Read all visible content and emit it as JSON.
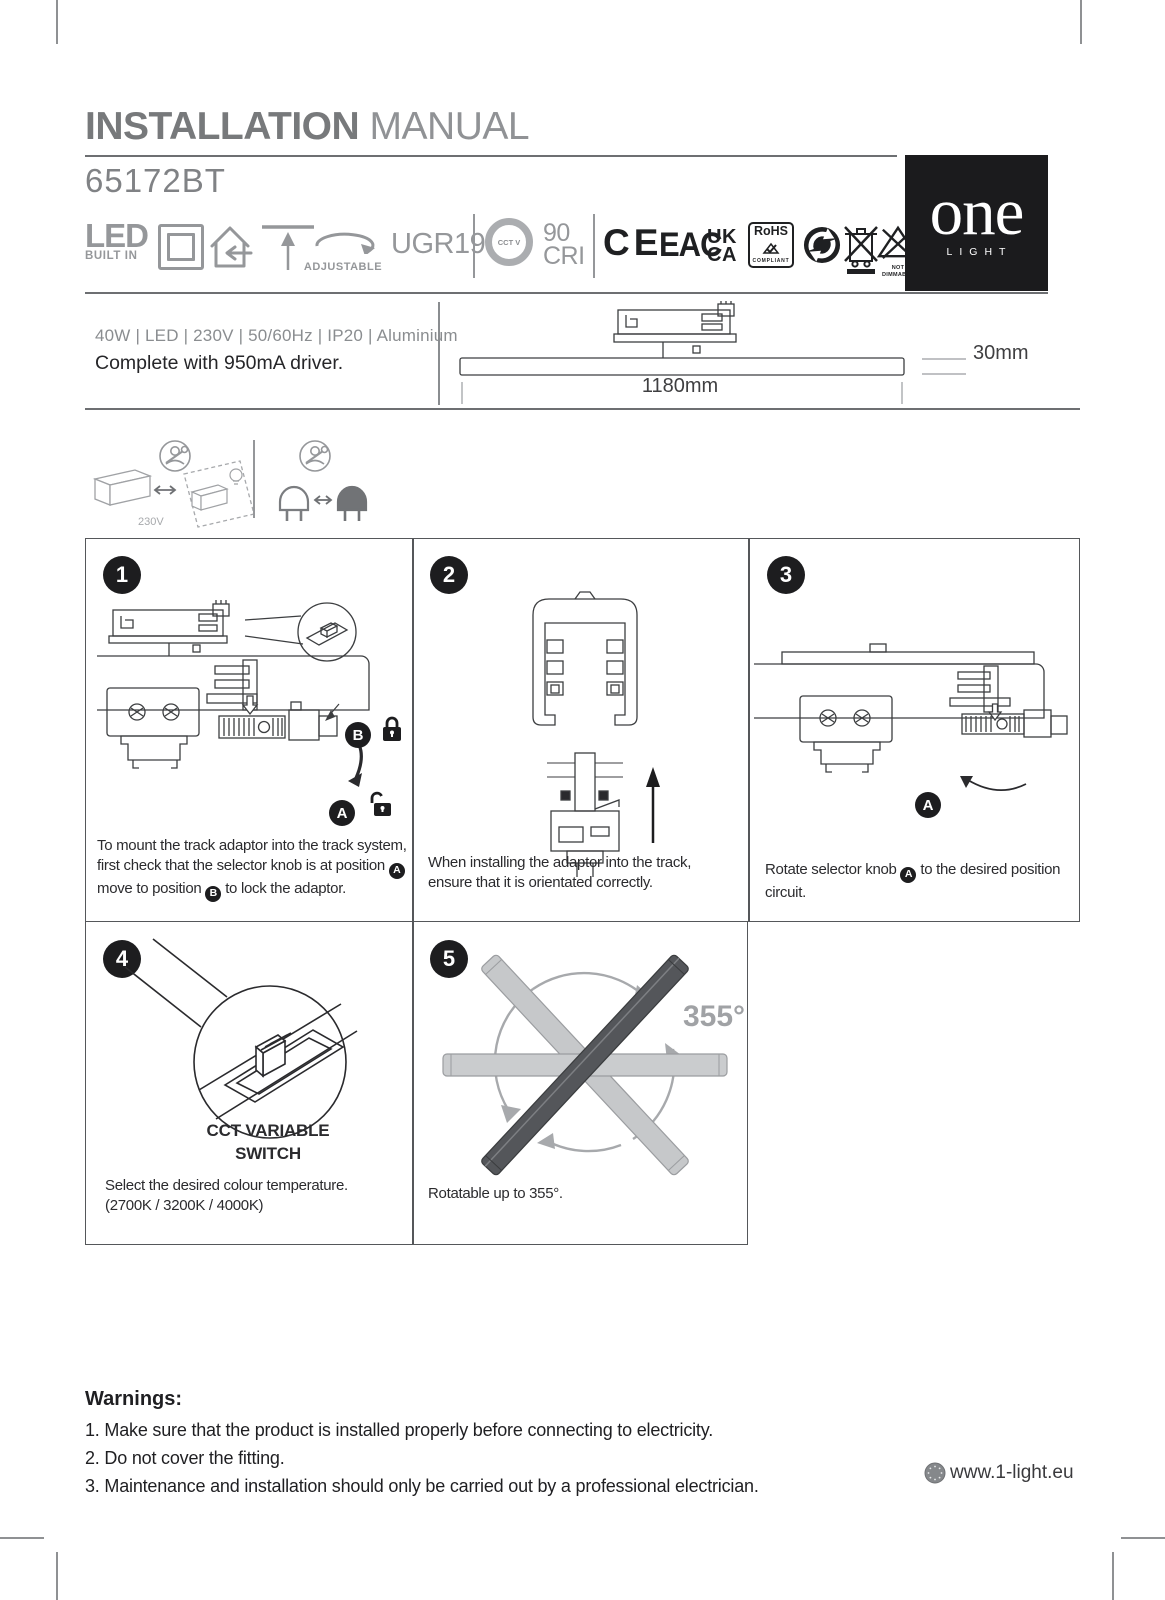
{
  "page": {
    "title_bold": "INSTALLATION",
    "title_light": "MANUAL",
    "product_code": "65172BT"
  },
  "badges_row": {
    "led_main": "LED",
    "led_sub": "BUILT IN",
    "adjustable": "ADJUSTABLE",
    "ugr": "UGR19",
    "cct": "CCT V",
    "cri_value": "90",
    "cri_label": "CRI",
    "ce": "CE",
    "eac": "EAC",
    "ukca_line1": "UK",
    "ukca_line2": "CA",
    "rohs": "RoHS",
    "rohs_sub": "COMPLIANT",
    "dimmable_line1": "NOT",
    "dimmable_line2": "DIMMABLE"
  },
  "brand": {
    "name": "one",
    "sub": "LIGHT"
  },
  "specs": {
    "line1": "40W  |  LED  |  230V  |  50/60Hz  |  IP20  |  Aluminium",
    "line2": "Complete with 950mA driver."
  },
  "product_drawing": {
    "length": "1180mm",
    "height": "30mm"
  },
  "safety": {
    "voltage": "230V"
  },
  "steps": {
    "s1": {
      "num": "1",
      "t1": "To mount the track adaptor into the track system, first check that the selector knob is at position",
      "b1": "A",
      "t2": "move to position",
      "b2": "B",
      "t3": "to lock the adaptor.",
      "badge_b": "B",
      "badge_a": "A"
    },
    "s2": {
      "num": "2",
      "t1": "When installing the adaptor into the track, ensure that it is orientated correctly."
    },
    "s3": {
      "num": "3",
      "t1": "Rotate selector knob",
      "b1": "A",
      "t2": "to the desired position circuit.",
      "badge_a": "A"
    },
    "s4": {
      "num": "4",
      "caption1": "CCT VARIABLE",
      "caption2": "SWITCH",
      "t1": "Select  the desired colour temperature.",
      "t2": "(2700K / 3200K / 4000K)"
    },
    "s5": {
      "num": "5",
      "angle": "355°",
      "t1": "Rotatable up to 355°."
    }
  },
  "warnings": {
    "title": "Warnings:",
    "item1": "1. Make sure that the product is installed properly before connecting to electricity.",
    "item2": "2. Do not cover the fitting.",
    "item3": "3. Maintenance and installation should only be carried out by a professional electrician."
  },
  "footer": {
    "website": "www.1-light.eu"
  },
  "colors": {
    "ink": "#262629",
    "icon_gray": "#95979A",
    "title_gray": "#77797B",
    "badge_black": "#1D1D1F"
  }
}
